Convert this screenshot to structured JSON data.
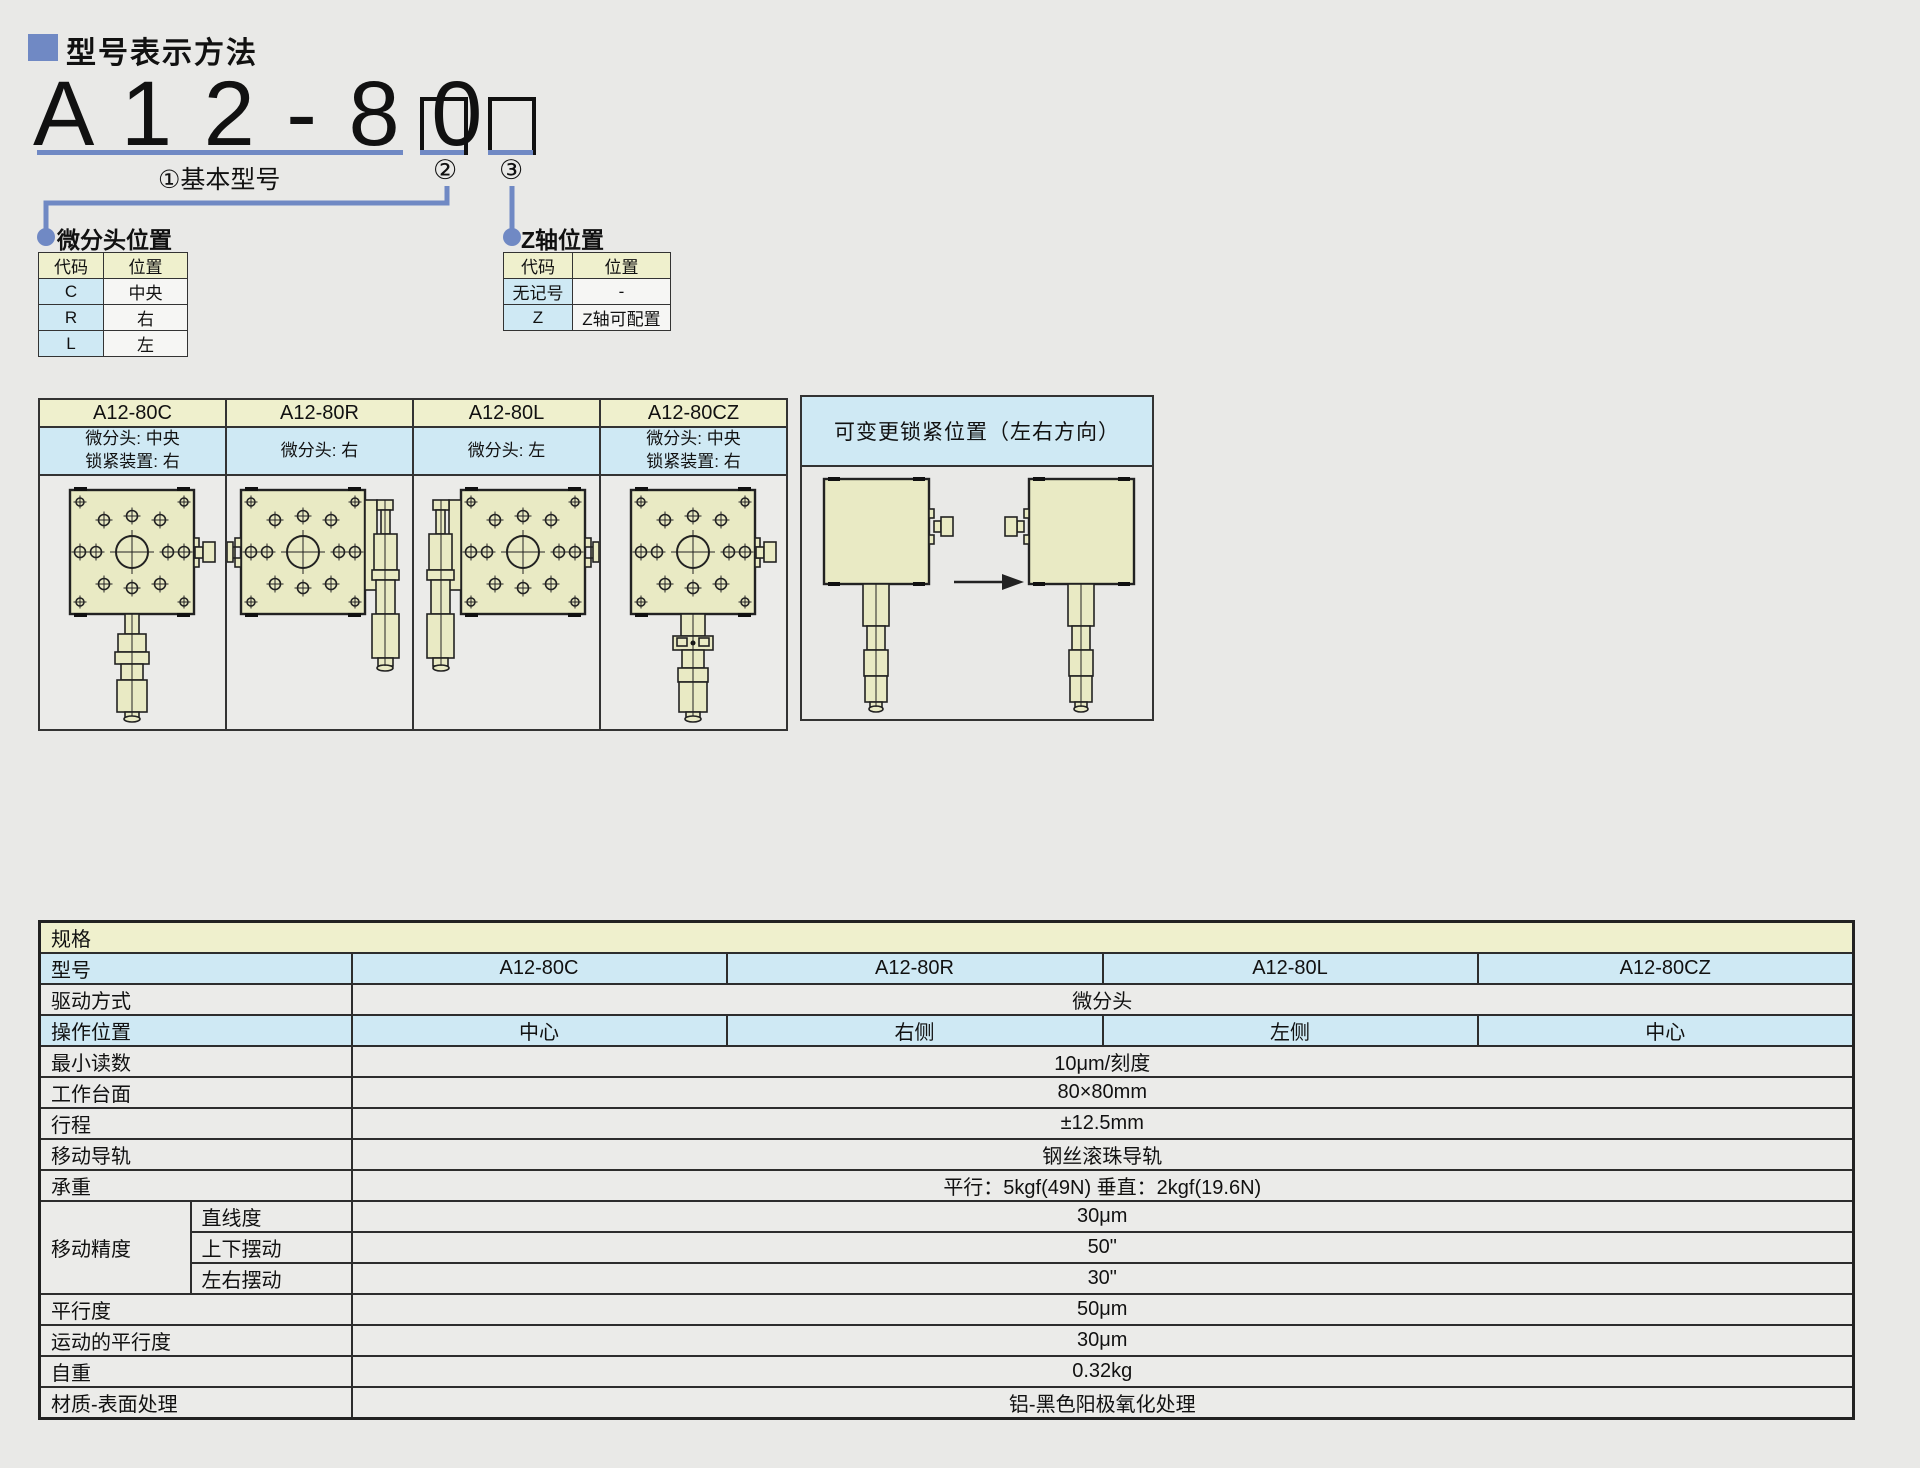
{
  "page": {
    "title": "型号表示方法"
  },
  "colors": {
    "accent_blue": "#7089c4",
    "header_green": "#eff0cd",
    "cell_blue": "#cfe9f4",
    "stage_fill": "#e9eac4",
    "page_bg": "#e9e9e7"
  },
  "model_code": {
    "big_text": "A 1 2 - 8 0",
    "base_label": "①基本型号",
    "tag2": "②",
    "tag3": "③"
  },
  "micrometer_position": {
    "title": "微分头位置",
    "headers": [
      "代码",
      "位置"
    ],
    "rows": [
      [
        "C",
        "中央"
      ],
      [
        "R",
        "右"
      ],
      [
        "L",
        "左"
      ]
    ]
  },
  "z_axis_position": {
    "title": "Z轴位置",
    "headers": [
      "代码",
      "位置"
    ],
    "rows": [
      [
        "无记号",
        "-"
      ],
      [
        "Z",
        "Z轴可配置"
      ]
    ]
  },
  "variants": [
    {
      "model": "A12-80C",
      "desc": "微分头: 中央\n锁紧装置: 右"
    },
    {
      "model": "A12-80R",
      "desc": "微分头: 右"
    },
    {
      "model": "A12-80L",
      "desc": "微分头: 左"
    },
    {
      "model": "A12-80CZ",
      "desc": "微分头: 中央\n锁紧装置: 右"
    }
  ],
  "lock_box": {
    "title": "可变更锁紧位置（左右方向）"
  },
  "specs": {
    "title": "规格",
    "model": {
      "label": "型号",
      "values": [
        "A12-80C",
        "A12-80R",
        "A12-80L",
        "A12-80CZ"
      ]
    },
    "drive": {
      "label": "驱动方式",
      "value": "微分头"
    },
    "op": {
      "label": "操作位置",
      "values": [
        "中心",
        "右侧",
        "左侧",
        "中心"
      ]
    },
    "simple1": [
      {
        "label": "最小读数",
        "value": "10μm/刻度"
      },
      {
        "label": "工作台面",
        "value": "80×80mm"
      },
      {
        "label": "行程",
        "value": "±12.5mm"
      },
      {
        "label": "移动导轨",
        "value": "钢丝滚珠导轨"
      },
      {
        "label": "承重",
        "value": "平行：5kgf(49N) 垂直：2kgf(19.6N)"
      }
    ],
    "accuracy": {
      "label": "移动精度",
      "rows": [
        {
          "sub": "直线度",
          "value": "30μm"
        },
        {
          "sub": "上下摆动",
          "value": "50\""
        },
        {
          "sub": "左右摆动",
          "value": "30\""
        }
      ]
    },
    "simple2": [
      {
        "label": "平行度",
        "value": "50μm"
      },
      {
        "label": "运动的平行度",
        "value": "30μm"
      },
      {
        "label": "自重",
        "value": "0.32kg"
      },
      {
        "label": "材质-表面处理",
        "value": "铝-黑色阳极氧化处理"
      }
    ]
  }
}
